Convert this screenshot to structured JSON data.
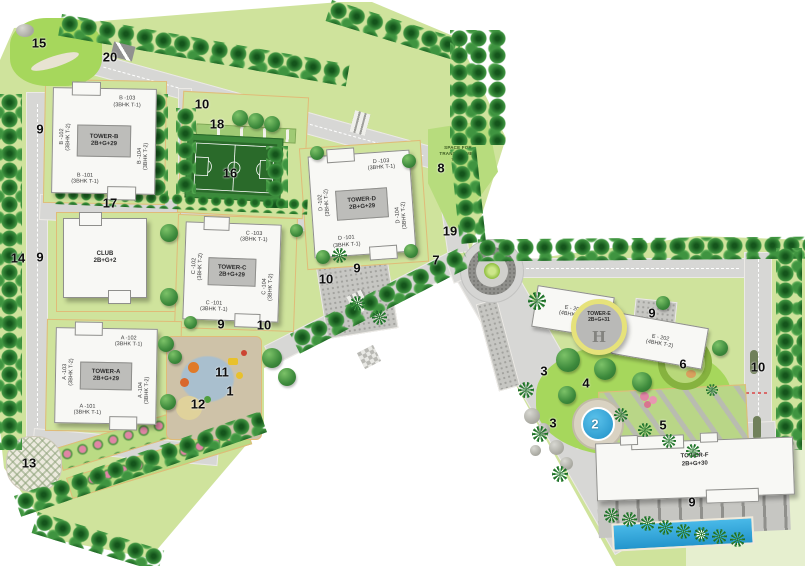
{
  "colors": {
    "lawn": "#cfe39c",
    "bright_lawn": "#a6d75c",
    "tree_green": "#2d7b31",
    "road_gray": "#d7d7d5",
    "building_white": "#f8f8f5",
    "core_gray": "#bdbdba",
    "water_blue": "#2fa9e0",
    "court_green": "#2a6a2a",
    "helipad_ring_yellow": "#e6e27a",
    "flower_pink": "#e085a5"
  },
  "towers": {
    "b": {
      "core": "TOWER-B\n2B+G+29",
      "top": "B -103\n(3BHK T-1)",
      "left": "B -102\n(3BHK T-2)",
      "right": "B -104\n(3BHK T-2)",
      "bottom": "B -101\n(3BHK T-1)"
    },
    "d": {
      "core": "TOWER-D\n2B+G+29",
      "top": "D -103\n(3BHK T-1)",
      "left": "D -102\n(3BHK T-2)",
      "right": "D -104\n(3BHK T-2)",
      "bottom": "D -101\n(3BHK T-1)"
    },
    "c": {
      "core": "TOWER-C\n2B+G+29",
      "top": "C -103\n(3BHK T-1)",
      "left": "C -102\n(3BHK T-2)",
      "right": "C -104\n(3BHK T-2)",
      "bottom": "C -101\n(3BHK T-1)"
    },
    "a": {
      "core": "TOWER-A\n2B+G+29",
      "top": "A -102\n(3BHK T-1)",
      "left": "A -103\n(3BHK T-2)",
      "right": "A -104\n(3BHK T-2)",
      "bottom": "A -101\n(3BHK T-1)"
    },
    "club": {
      "core": "CLUB\n2B+G+2"
    },
    "e": {
      "core": "TOWER-E\n2B+G+31",
      "left_wing": "E - 201\n(4BHK T-1)",
      "right_wing": "E - 202\n(4BHK T-2)",
      "helipad": "H"
    },
    "f": {
      "core": "TOWER-F\n2B+G+30"
    }
  },
  "labels": {
    "transformer_yard": "SPACE FOR\nTRANSFORMER\nYARD"
  },
  "markers": [
    "15",
    "20",
    "10",
    "18",
    "16",
    "9",
    "17",
    "14",
    "9",
    "13",
    "8",
    "19",
    "7",
    "9",
    "10",
    "9",
    "10",
    "11",
    "1",
    "12",
    "3",
    "4",
    "3",
    "2",
    "5",
    "6",
    "9",
    "10",
    "9"
  ]
}
